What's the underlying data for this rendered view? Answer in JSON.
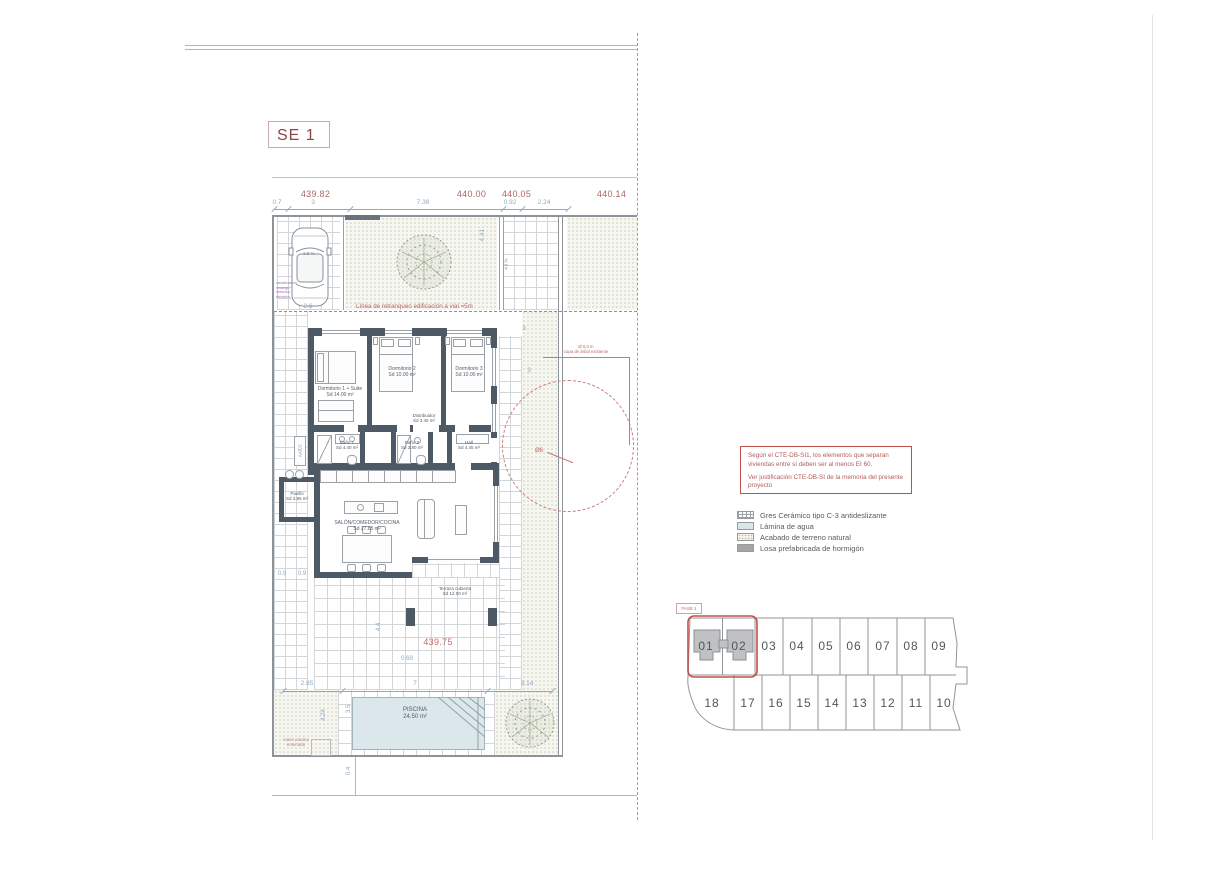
{
  "sheet": {
    "code": "SE 1"
  },
  "top_dimensions": {
    "red": [
      "439.82",
      "440.00",
      "440.05",
      "440.14"
    ],
    "blue": [
      "0.7",
      "3",
      "7.38",
      "0.92",
      "2.24"
    ]
  },
  "dims": {
    "parking_width": "2.6",
    "garden_depth": "4.41",
    "side_top": "3",
    "side_mid": "3",
    "patio_a": "0.9",
    "patio_b": "0.9",
    "patio_depth": "4.4",
    "level_offset": "0.69",
    "pool_top_left": "2.85",
    "pool_top_mid": "7",
    "pool_top_right": "3.14",
    "pool_side_a": "4.24",
    "pool_side_b": "3.5",
    "street_offset": "0.4"
  },
  "slopes": {
    "parking": "2.5 %",
    "garden": "4.9 %"
  },
  "annotations": {
    "setback_front": "Línea de retranqueo edificación a vial =5m",
    "tree_note_1": "Ø 6,0 m",
    "tree_note_2": "copa de árbol existente",
    "tree_diameter": "Ø6",
    "ev_line1": "canalización recarga",
    "ev_line2": "vehículo eléctrico",
    "aacc": "AA/CC",
    "pool_motor": "motor piscina enterrado",
    "level_main": "439.75",
    "fase": "FASE 1"
  },
  "rooms": [
    {
      "name": "Dormitorio 1 + Suite",
      "area": "Sd 14.00 m²"
    },
    {
      "name": "Dormitorio 2",
      "area": "Sd 10.00 m²"
    },
    {
      "name": "Dormitorio 3",
      "area": "Sd 10.00 m²"
    },
    {
      "name": "Distribuidor",
      "area": "Sd 3.40 m²"
    },
    {
      "name": "Baño 1",
      "area": "Sd 4.40 m²"
    },
    {
      "name": "Baño 2",
      "area": "Sd 3.80 m²"
    },
    {
      "name": "Hall",
      "area": "Sd 4.45 m²"
    },
    {
      "name": "Pasillo",
      "area": "Sd 3.85 m²"
    },
    {
      "name": "SALÓN/COMEDOR/COCINA",
      "area": "Sd 27.85 m²"
    },
    {
      "name": "Terraza cubierta",
      "area": "Sd 12.00 m²"
    }
  ],
  "pool": {
    "name": "PISCINA",
    "area": "24.50 m²"
  },
  "note_box": {
    "para1": "Según el CTE-DB-SI1, los elementos que separan viviendas entre sí deben ser al menos EI 60.",
    "para2": "Ver justificación CTE-DB-SI de la memoria del presente proyecto"
  },
  "legend": {
    "items": [
      {
        "label": "Gres Cerámico tipo C-3 antideslizante"
      },
      {
        "label": "Lámina de agua"
      },
      {
        "label": "Acabado de terreno natural"
      },
      {
        "label": "Losa prefabricada de hormigón"
      }
    ]
  },
  "plot_map": {
    "top_row": [
      "01",
      "02",
      "03",
      "04",
      "05",
      "06",
      "07",
      "08",
      "09"
    ],
    "bottom_row": [
      "18",
      "17",
      "16",
      "15",
      "14",
      "13",
      "12",
      "11",
      "10"
    ]
  }
}
